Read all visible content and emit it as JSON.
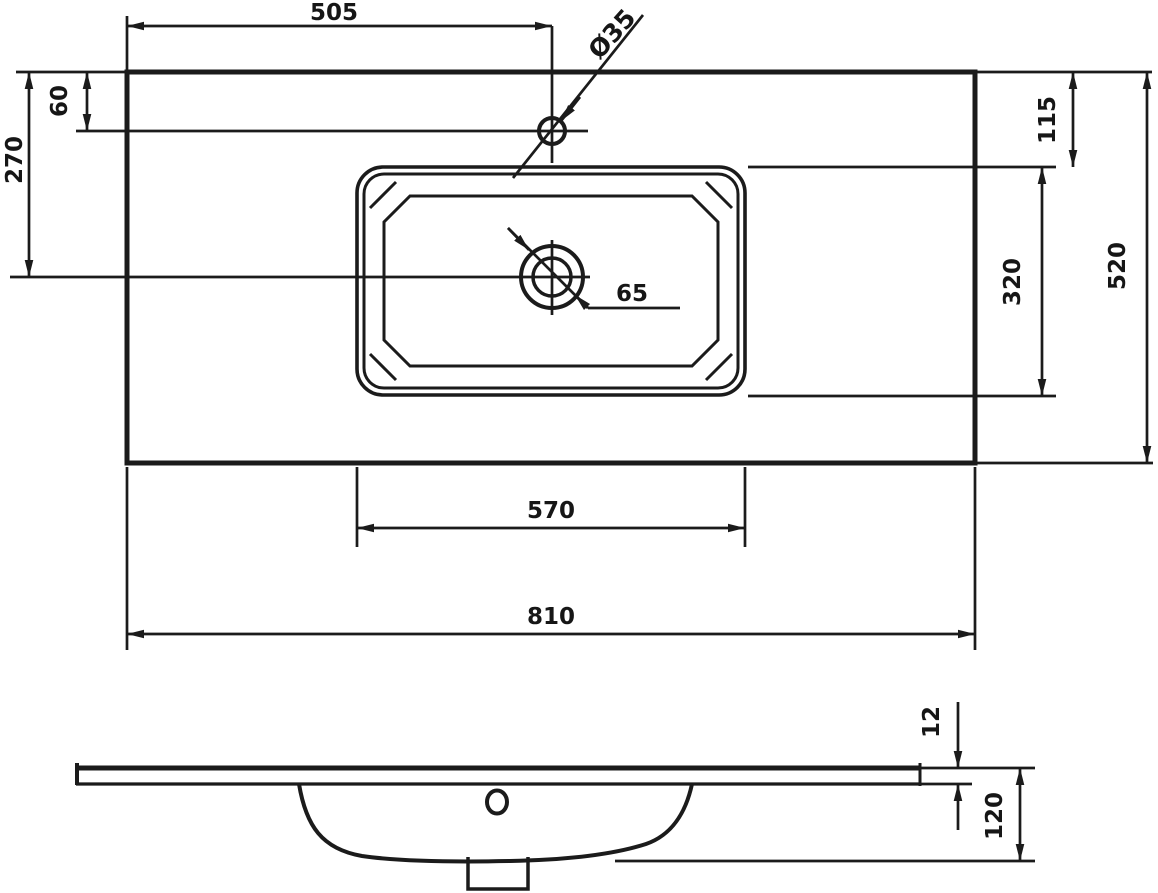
{
  "drawing": {
    "line_color": "#1b1b1b",
    "background_color": "#ffffff"
  },
  "top_view": {
    "faucet_from_left": "505",
    "faucet_hole_diameter": "Ø35",
    "faucet_from_back_edge": "60",
    "drain_center_from_back_edge": "270",
    "basin_from_back_edge": "115",
    "basin_depth": "320",
    "countertop_depth": "520",
    "drain_hole_diameter": "65",
    "basin_width": "570",
    "countertop_width": "810"
  },
  "front_view": {
    "countertop_thickness": "12",
    "basin_height": "120"
  }
}
